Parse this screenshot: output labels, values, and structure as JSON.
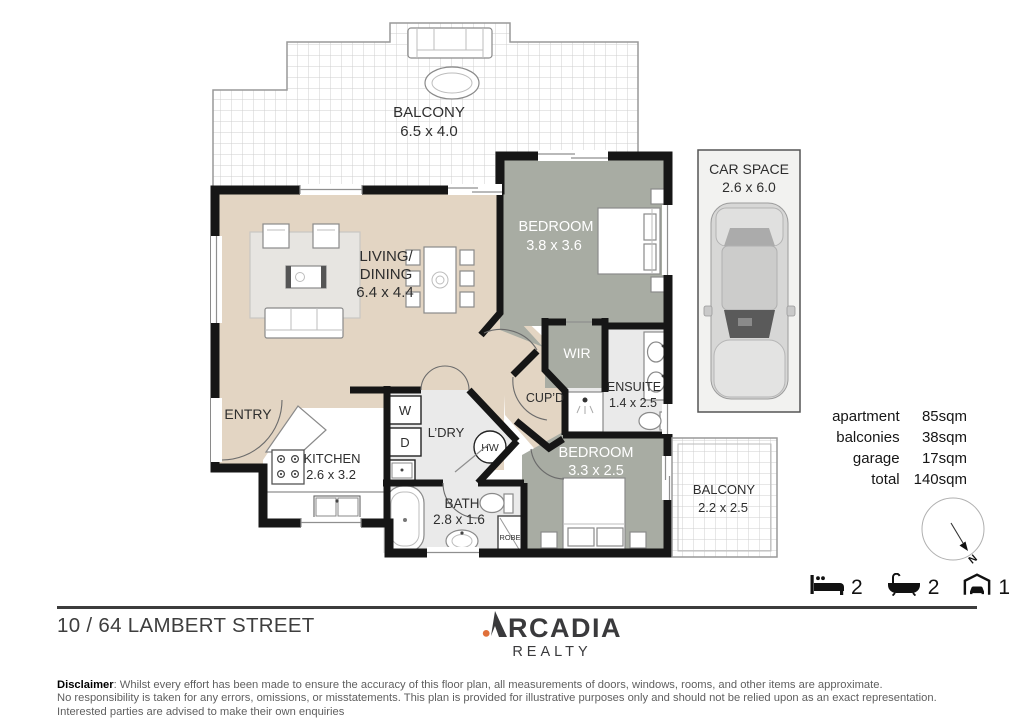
{
  "colors": {
    "wall": "#161616",
    "floor_beige": "#e3d5c3",
    "floor_gray": "#a8aca3",
    "floor_light": "#eaeaea",
    "accent_orange": "#e0703a",
    "balcony_grid": "#cfcfcf",
    "car_space_bg": "#f2f2f0"
  },
  "plan": {
    "balcony_main": {
      "label": "BALCONY",
      "dims": "6.5 x 4.0"
    },
    "bedroom_main": {
      "label": "BEDROOM",
      "dims": "3.8 x 3.6"
    },
    "living_dining": {
      "label_line1": "LIVING/",
      "label_line2": "DINING",
      "dims": "6.4 x 4.4"
    },
    "wir": {
      "label": "WIR"
    },
    "ensuite": {
      "label": "ENSUITE",
      "dims": "1.4 x 2.5"
    },
    "cupboard": {
      "label": "CUP’D"
    },
    "entry": {
      "label": "ENTRY"
    },
    "kitchen": {
      "label": "KITCHEN",
      "dims": "2.6 x 3.2"
    },
    "laundry": {
      "label": "L’DRY",
      "washer": "W",
      "dryer": "D"
    },
    "hot_water": {
      "label": "HW"
    },
    "bath": {
      "label": "BATH",
      "dims": "2.8 x 1.6"
    },
    "robe": {
      "label": "ROBE"
    },
    "bedroom_2": {
      "label": "BEDROOM",
      "dims": "3.3 x 2.5"
    },
    "balcony_2": {
      "label": "BALCONY",
      "dims": "2.2 x 2.5"
    },
    "car_space": {
      "label": "CAR SPACE",
      "dims": "2.6 x 6.0"
    },
    "compass": {
      "north": "N"
    }
  },
  "areas": {
    "rows": [
      {
        "label": "apartment",
        "value": "85sqm"
      },
      {
        "label": "balconies",
        "value": "38sqm"
      },
      {
        "label": "garage",
        "value": "17sqm"
      },
      {
        "label": "total",
        "value": "140sqm"
      }
    ]
  },
  "features": {
    "beds": "2",
    "baths": "2",
    "cars": "1"
  },
  "footer": {
    "address": "10 / 64 LAMBERT STREET",
    "logo": {
      "mark_letter": "A",
      "word_rest": "RCADIA",
      "subtitle": "REALTY"
    }
  },
  "disclaimer": {
    "title": "Disclaimer",
    "line1": ": Whilst every effort has been made to ensure the accuracy of this floor plan, all measurements of doors, windows, rooms, and other items are approximate.",
    "line2": "No responsibility is taken for any errors, omissions, or misstatements. This plan is provided for illustrative purposes only and should not be relied upon as an exact representation.",
    "line3": "Interested parties are advised to make their own enquiries"
  }
}
